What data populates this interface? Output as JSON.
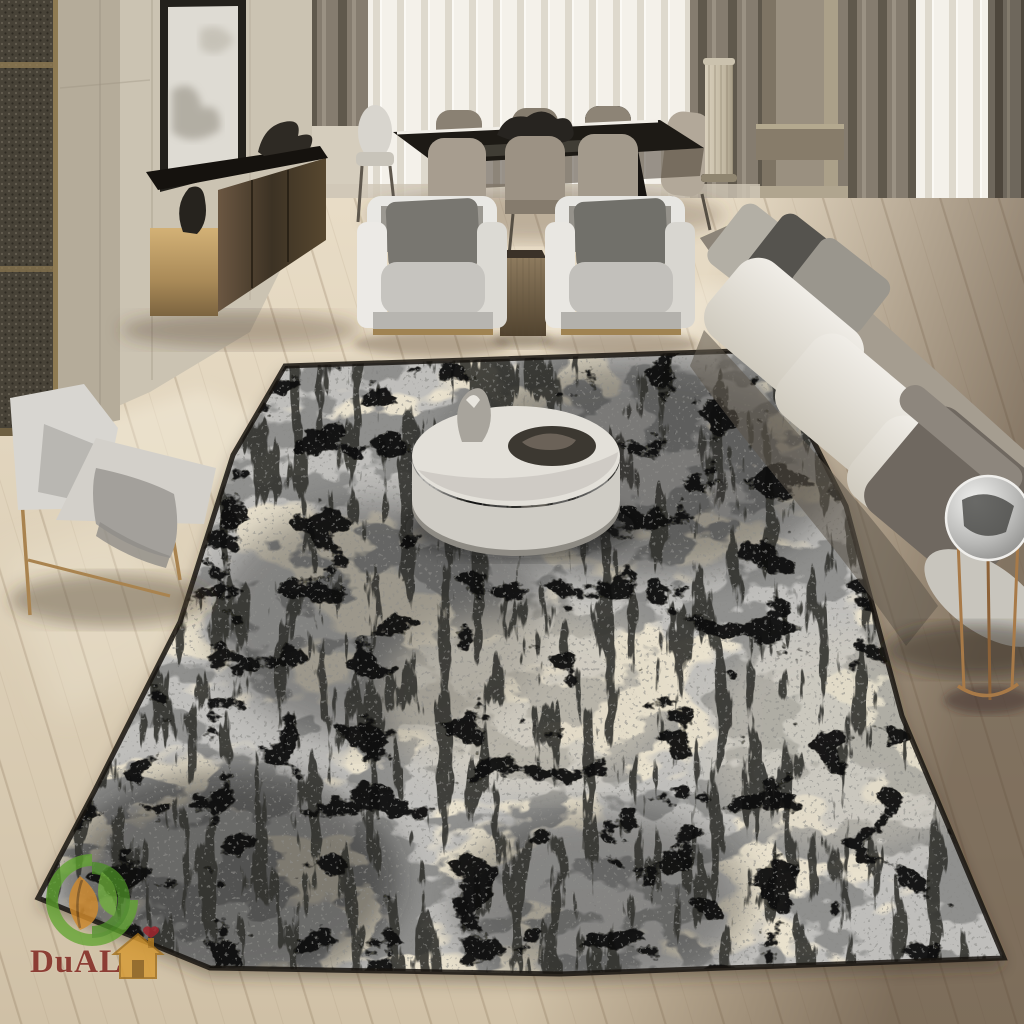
{
  "watermark": {
    "brand": "DuALi",
    "brand_color": "#7d211b",
    "mark_colors": {
      "leaf_green": "#5ea32e",
      "leaf_dark_green": "#2f6b1f",
      "inner_leaf_orange": "#cf8a2e",
      "house_gold": "#d79a33",
      "heart_red": "#a3242c"
    }
  },
  "scene": {
    "objects": [
      "area-rug",
      "coffee-table",
      "sofa",
      "armchair-pair",
      "accent-chair",
      "dining-table",
      "dining-chairs",
      "console-sideboard",
      "wall-art",
      "floor-lamp",
      "side-table",
      "curtains",
      "columns",
      "wood-floor"
    ],
    "palette": {
      "rug_base": "#bfbebb",
      "rug_cream": "#e9e1cd",
      "rug_mid_gray": "#8f8f8d",
      "rug_charcoal": "#33332f",
      "rug_black": "#0d0d0c",
      "floor_light": "#e2d5bf",
      "floor_shadow": "#7b6b5c",
      "wall": "#cbc3b2",
      "drape": "#7e766a",
      "sheer": "#f2efe8",
      "sofa_cushion": "#e8e5df",
      "brass": "#a08352",
      "console_gold": "#caa76b"
    }
  }
}
